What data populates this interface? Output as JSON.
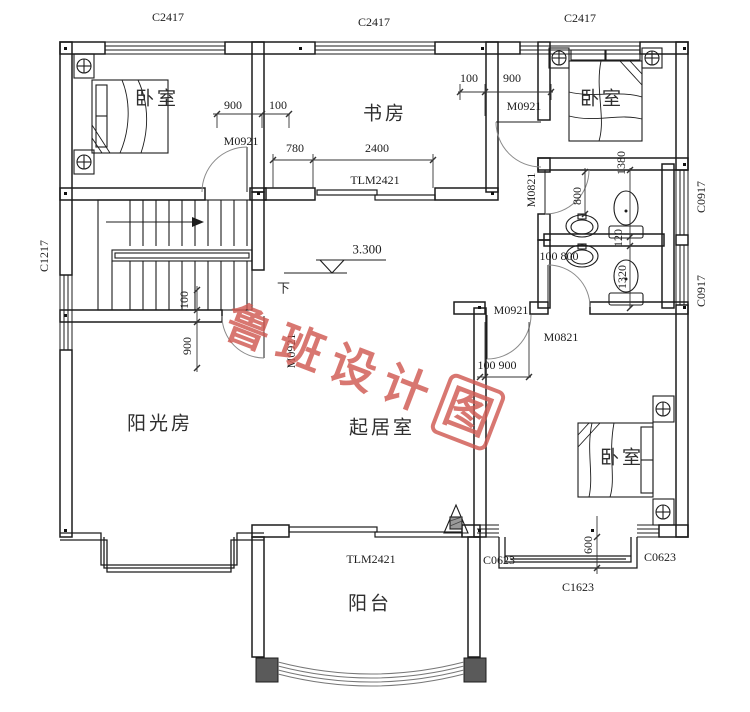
{
  "meta": {
    "line_color": "#1c1c1c",
    "watermark_color": "#d05a52"
  },
  "rooms": {
    "bedroom_tl": "卧室",
    "study": "书房",
    "bedroom_tr": "卧室",
    "sunroom": "阳光房",
    "living": "起居室",
    "bedroom_br": "卧室",
    "balcony": "阳台"
  },
  "windows": {
    "top_left": "C2417",
    "top_mid": "C2417",
    "top_right": "C2417",
    "left": "C1217",
    "right_upper": "C0917",
    "right_lower": "C0917",
    "bottom_left_small": "C0623",
    "bottom_right_small": "C0623",
    "bay": "C1623"
  },
  "doors": {
    "bedroom_tl": "M0921",
    "bedroom_tr": "M0921",
    "sunroom": "M0921",
    "bedroom_br": "M0921",
    "bath1": "M0821",
    "bath2": "M0821",
    "study_sliding": "TLM2421",
    "balcony_sliding": "TLM2421"
  },
  "dims": {
    "tl_900": "900",
    "tl_100": "100",
    "study_780": "780",
    "study_2400": "2400",
    "tr_100": "100",
    "tr_900": "900",
    "bath1_800": "800",
    "bath1_1380": "1380",
    "wall_120": "120",
    "bath2_1320": "1320",
    "bath2_door": "100 800",
    "br_door": "100 900",
    "sun_100": "100",
    "sun_900": "900",
    "bay_600": "600"
  },
  "annotations": {
    "elevation": "3.300",
    "down": "下"
  },
  "watermark": {
    "text": "鲁班设计",
    "boxed": "图"
  }
}
